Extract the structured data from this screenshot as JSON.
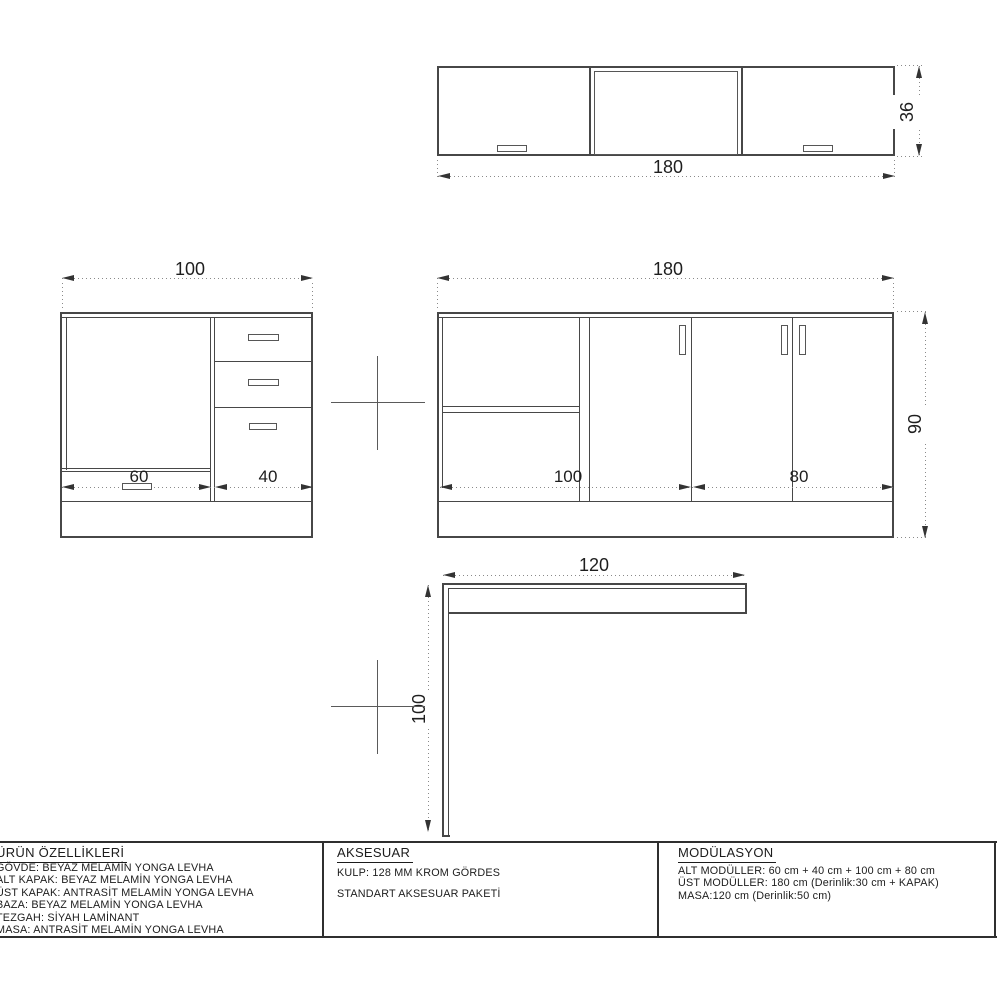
{
  "drawings": {
    "wall_cabinet": {
      "width_cm": "180",
      "height_cm": "36"
    },
    "left_base_cabinet": {
      "width_cm": "100",
      "door_cm": "60",
      "drawers_cm": "40"
    },
    "right_base_cabinet": {
      "width_cm": "180",
      "height_cm": "90",
      "left_section_cm": "100",
      "right_section_cm": "80"
    },
    "desk_profile": {
      "width_cm": "120",
      "height_cm": "100"
    }
  },
  "spec_table": {
    "product_features": {
      "title": "ÜRÜN ÖZELLİKLERİ",
      "rows": [
        "GÖVDE: BEYAZ MELAMİN YONGA LEVHA",
        "ALT KAPAK: BEYAZ MELAMİN YONGA LEVHA",
        "ÜST KAPAK: ANTRASİT MELAMİN YONGA LEVHA",
        "BAZA: BEYAZ MELAMİN YONGA LEVHA",
        "TEZGAH: SİYAH LAMİNANT",
        "MASA: ANTRASİT MELAMİN YONGA LEVHA"
      ]
    },
    "accessories": {
      "title": "AKSESUAR",
      "rows": [
        "KULP: 128 MM KROM GÖRDES",
        "STANDART AKSESUAR PAKETİ"
      ]
    },
    "modulation": {
      "title": "MODÜLASYON",
      "rows": [
        "ALT MODÜLLER: 60 cm + 40 cm + 100 cm + 80 cm",
        "ÜST MODÜLLER: 180 cm (Derinlik:30 cm + KAPAK)",
        "MASA:120 cm (Derinlik:50 cm)"
      ]
    }
  }
}
